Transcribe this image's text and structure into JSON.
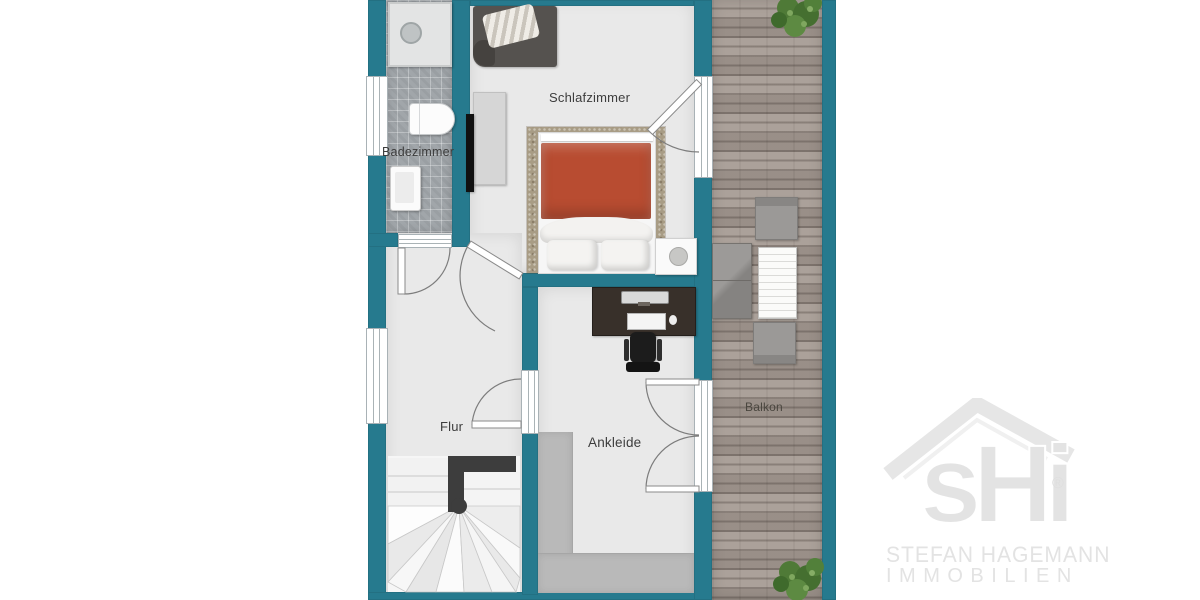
{
  "rooms": {
    "schlafzimmer": "Schlafzimmer",
    "badezimmer": "Badezimmer",
    "flur": "Flur",
    "ankleide": "Ankleide",
    "balkon": "Balkon"
  },
  "logo": {
    "monogram": "sHi",
    "registered": "®",
    "line1": "STEFAN HAGEMANN",
    "line2": "IMMOBILIEN"
  },
  "colors": {
    "wall": "#267a8e",
    "floor": "#e9e9e9",
    "tile": "#a1a6aa",
    "deck": "#a59a92",
    "rug": "#a89c85",
    "duvet": "#b84c31",
    "wardrobe": "#b9b9b9",
    "rail": "#3d3d3d",
    "label": "#3d3d3d",
    "logo": "#e3e3e3"
  }
}
